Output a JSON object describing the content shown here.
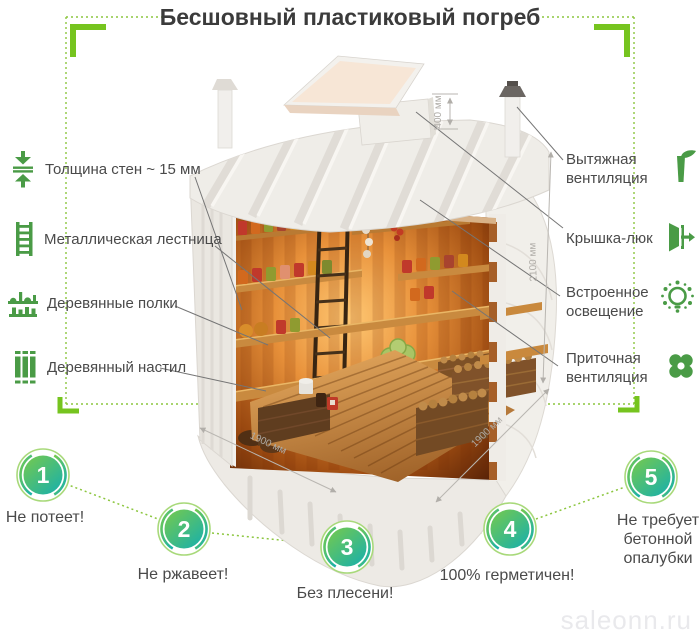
{
  "title": "Бесшовный пластиковый погреб",
  "left_labels": [
    {
      "icon": "wall-thickness-icon",
      "label": "Толщина стен ~ 15 мм"
    },
    {
      "icon": "ladder-icon",
      "label": "Металлическая лестница"
    },
    {
      "icon": "shelves-icon",
      "label": "Деревянные полки"
    },
    {
      "icon": "planks-icon",
      "label": "Деревянный настил"
    }
  ],
  "right_labels": [
    {
      "icon": "exhaust-vent-icon",
      "label": "Вытяжная вентиляция"
    },
    {
      "icon": "hatch-icon",
      "label": "Крышка-люк"
    },
    {
      "icon": "light-icon",
      "label": "Встроенное освещение"
    },
    {
      "icon": "intake-vent-icon",
      "label": "Приточная вентиляция"
    }
  ],
  "dimensions": {
    "hatch_height": "400 мм",
    "body_height": "2100 мм",
    "width": "1900 мм",
    "depth": "1900 мм"
  },
  "features": [
    {
      "number": "1",
      "label": "Не потеет!"
    },
    {
      "number": "2",
      "label": "Не ржавеет!"
    },
    {
      "number": "3",
      "label": "Без плесени!"
    },
    {
      "number": "4",
      "label": "100% герметичен!"
    },
    {
      "number": "5",
      "label": "Не требует бетонной опалубки"
    }
  ],
  "watermark": "saleonn.ru",
  "colors": {
    "accent_green": "#76c41f",
    "icon_green": "#4a9b46",
    "badge_gradient_start": "#77ca4c",
    "badge_gradient_end": "#1cb1a7",
    "badge_ring": "#a8d97a"
  }
}
